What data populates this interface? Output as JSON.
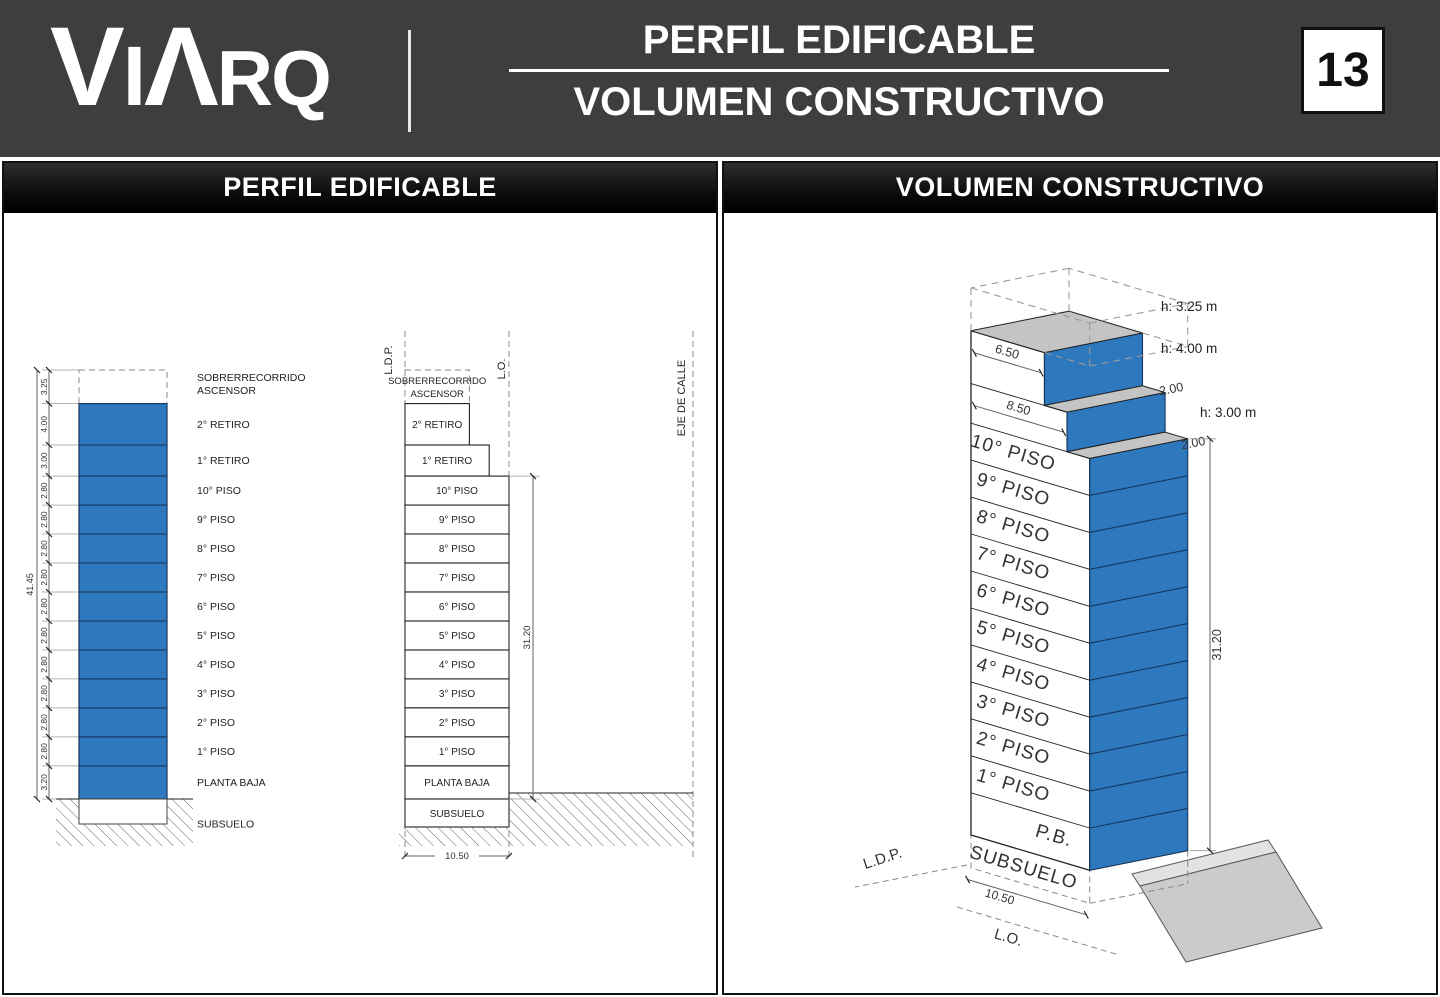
{
  "header": {
    "logo_letters": [
      "V",
      "I",
      "Λ",
      "R",
      "Q"
    ],
    "title_line1": "PERFIL EDIFICABLE",
    "title_line2": "VOLUMEN CONSTRUCTIVO",
    "page_number": "13"
  },
  "colors": {
    "header_bg": "#3E3E40",
    "building_blue": "#2E78BD",
    "blue_edge": "#16365C",
    "roof_gray": "#C4C4C4",
    "ramp_gray": "#CBCBCB",
    "curb_gray": "#E2E2E2",
    "line_dark": "#222222",
    "dim_gray": "#606060"
  },
  "left_panel": {
    "title": "PERFIL EDIFICABLE",
    "overall_height_dim": "41.45",
    "tower_height_dim": "31.20",
    "lot_width_dim": "10.50",
    "elevator_overrun": {
      "line1": "SOBRERRECORRIDO",
      "line2": "ASCENSOR",
      "dim": "3.25",
      "height_m": 3.25,
      "width_m": 6.5
    },
    "levels": [
      {
        "label": "2° RETIRO",
        "dim": "4.00",
        "height_m": 4.0,
        "width_m": 6.5
      },
      {
        "label": "1° RETIRO",
        "dim": "3.00",
        "height_m": 3.0,
        "width_m": 8.5
      },
      {
        "label": "10° PISO",
        "dim": "2.80",
        "height_m": 2.8,
        "width_m": 10.5
      },
      {
        "label": "9° PISO",
        "dim": "2.80",
        "height_m": 2.8,
        "width_m": 10.5
      },
      {
        "label": "8° PISO",
        "dim": "2.80",
        "height_m": 2.8,
        "width_m": 10.5
      },
      {
        "label": "7° PISO",
        "dim": "2.80",
        "height_m": 2.8,
        "width_m": 10.5
      },
      {
        "label": "6° PISO",
        "dim": "2.80",
        "height_m": 2.8,
        "width_m": 10.5
      },
      {
        "label": "5° PISO",
        "dim": "2.80",
        "height_m": 2.8,
        "width_m": 10.5
      },
      {
        "label": "4° PISO",
        "dim": "2.80",
        "height_m": 2.8,
        "width_m": 10.5
      },
      {
        "label": "3° PISO",
        "dim": "2.80",
        "height_m": 2.8,
        "width_m": 10.5
      },
      {
        "label": "2° PISO",
        "dim": "2.80",
        "height_m": 2.8,
        "width_m": 10.5
      },
      {
        "label": "1° PISO",
        "dim": "2.80",
        "height_m": 2.8,
        "width_m": 10.5
      },
      {
        "label": "PLANTA BAJA",
        "dim": "3.20",
        "height_m": 3.2,
        "width_m": 10.5
      }
    ],
    "basement_label": "SUBSUELO",
    "reference_lines": {
      "ldp": "L.D.P.",
      "lo": "L.O.",
      "street_axis": "EJE DE CALLE"
    }
  },
  "right_panel": {
    "title": "VOLUMEN CONSTRUCTIVO",
    "floor_labels": [
      "10° PISO",
      "9° PISO",
      "8° PISO",
      "7° PISO",
      "6° PISO",
      "5° PISO",
      "4° PISO",
      "3° PISO",
      "2° PISO",
      "1° PISO"
    ],
    "ground_floor_label": "P.B.",
    "basement_label": "SUBSUELO",
    "height_labels": [
      "h: 3.25 m",
      "h: 4.00 m",
      "h: 3.00 m"
    ],
    "width_dims": {
      "top_block": "6.50",
      "middle_block": "8.50",
      "bottom": "10.50"
    },
    "setback_dims": [
      "2.00",
      "2.00"
    ],
    "tower_height_dim": "31.20",
    "boundary_labels": {
      "ldp": "L.D.P.",
      "lo": "L.O."
    }
  }
}
